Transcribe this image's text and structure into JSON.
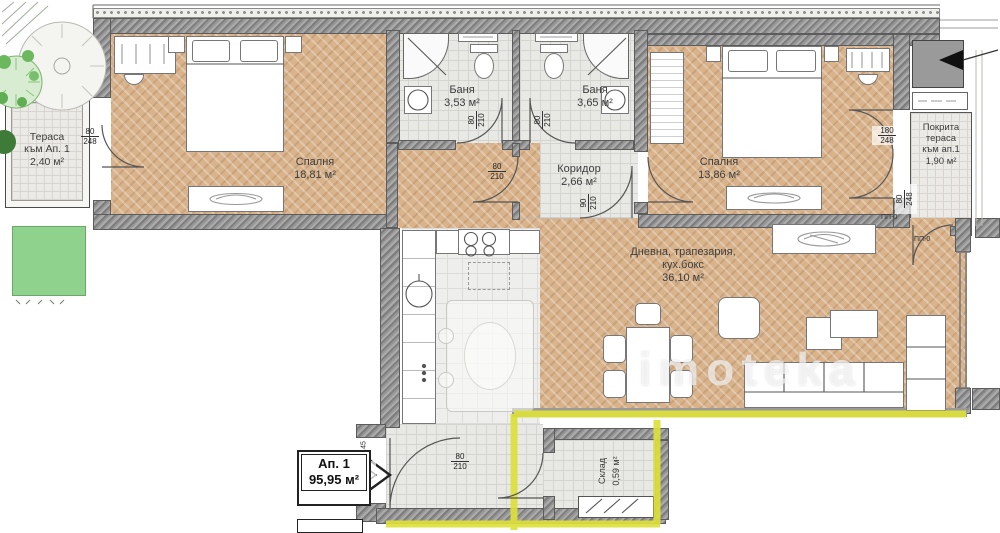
{
  "plan": {
    "watermark": "imoteka",
    "badge": {
      "name": "Ап. 1",
      "area": "95,95 м²"
    },
    "rooms": {
      "terrace_left": {
        "l1": "Тераса",
        "l2": "към Ап. 1",
        "area": "2,40 м²"
      },
      "bedroom1": {
        "name": "Спалня",
        "area": "18,81 м²"
      },
      "bath1": {
        "name": "Баня",
        "area": "3,53 м²"
      },
      "bath2": {
        "name": "Баня",
        "area": "3,65 м²"
      },
      "corridor": {
        "name": "Коридор",
        "area": "2,66 м²"
      },
      "bedroom2": {
        "name": "Спалня",
        "area": "13,86 м²"
      },
      "terrace_right": {
        "l1": "Покрита",
        "l2": "тераса",
        "l3": "към ап.1",
        "area": "1,90 м²"
      },
      "living": {
        "l1": "Дневна, трапезария,",
        "l2": "кух.бокс",
        "area": "36,10 м²"
      },
      "storage": {
        "name": "Склад",
        "area": "0,59 м²"
      }
    },
    "dims": {
      "terrace_left_door": {
        "w": "80",
        "h": "248"
      },
      "bath1_door": {
        "w": "80",
        "h": "210"
      },
      "bath2_door": {
        "w": "80",
        "h": "210"
      },
      "corridor_door": {
        "w": "80",
        "h": "210"
      },
      "living_corridor_door": {
        "w": "90",
        "h": "210"
      },
      "bedroom2_terrace_door": {
        "w": "180",
        "h": "248"
      },
      "terrace_right_door": {
        "w": "80",
        "h": "248"
      },
      "entrance_door": {
        "w": "100",
        "h": "210"
      },
      "storage_door": {
        "w": "80",
        "h": "210"
      }
    },
    "marks": {
      "pp0_a": "ПП-0",
      "pp0_b": "ПП-0",
      "floor": "Ет.45"
    },
    "colors": {
      "wood": "#d8b38b",
      "tile": "#e8e8e5",
      "wall": "#8b8b8b",
      "boundary_yellow": "#dde039",
      "grass_green": "#8ed28e"
    }
  }
}
